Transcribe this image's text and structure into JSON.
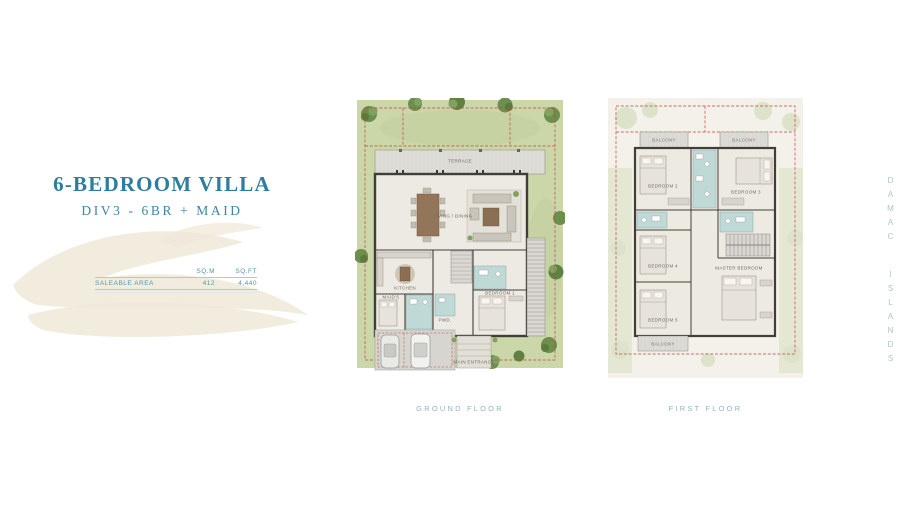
{
  "header": {
    "title": "6-BEDROOM VILLA",
    "subtitle": "DIV3 - 6BR + MAID"
  },
  "area_table": {
    "columns": [
      "SQ.M",
      "SQ.FT"
    ],
    "rows": [
      {
        "label": "SALEABLE AREA",
        "sqm": "412",
        "sqft": "4,440"
      }
    ]
  },
  "plans": {
    "ground": {
      "caption": "GROUND FLOOR",
      "labels": [
        {
          "text": "TERRACE"
        },
        {
          "text": "LIVING / DINING"
        },
        {
          "text": "KITCHEN"
        },
        {
          "text": "MAID'S"
        },
        {
          "text": "PWD."
        },
        {
          "text": "BEDROOM 1"
        },
        {
          "text": "MAIN ENTRANCE"
        }
      ]
    },
    "first": {
      "caption": "FIRST FLOOR",
      "labels": [
        {
          "text": "BALCONY"
        },
        {
          "text": "BALCONY"
        },
        {
          "text": "BEDROOM 2"
        },
        {
          "text": "BEDROOM 3"
        },
        {
          "text": "BEDROOM 4"
        },
        {
          "text": "BEDROOM 5"
        },
        {
          "text": "MASTER BEDROOM"
        },
        {
          "text": "BALCONY"
        }
      ]
    }
  },
  "brand": {
    "vertical_text": "DAMAC ISLANDS"
  },
  "colors": {
    "accent_teal": "#2e7d9e",
    "caption_teal": "#8fb6c2",
    "table_teal": "#5695ab",
    "garden_green": "#cbd6a9",
    "wet_area_teal": "#bfd9d7",
    "boundary_red": "#c1463c",
    "wall_dark": "#413d39",
    "watermark_beige": "#f2ecdf"
  }
}
